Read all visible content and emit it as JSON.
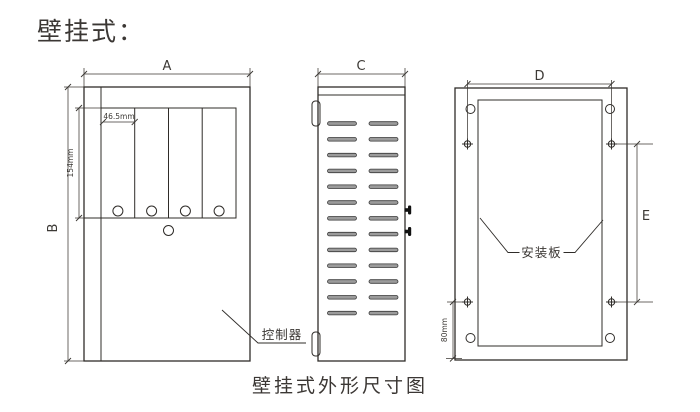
{
  "title": "壁挂式：",
  "caption": "壁挂式外形尺寸图",
  "colors": {
    "line": "#2f2c29",
    "dim": "#3c3935",
    "text": "#3b3734",
    "slot_fill": "#9b9b9b",
    "background": "#ffffff"
  },
  "front_view": {
    "dim_width": "A",
    "dim_height": "B",
    "dim_slot_width": "46.5mm",
    "dim_slot_height": "154mm",
    "callout_controller": "控制器"
  },
  "side_view": {
    "dim_depth": "C"
  },
  "back_view": {
    "dim_hole_span": "D",
    "dim_hole_pitch": "E",
    "dim_bottom_offset": "80mm",
    "callout_mounting_plate": "安装板"
  }
}
